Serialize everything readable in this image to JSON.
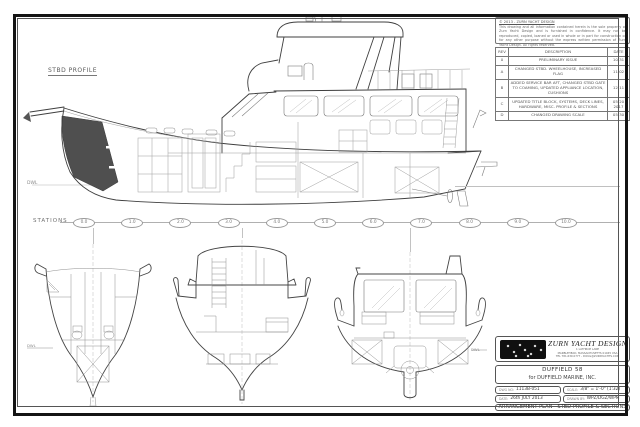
{
  "drawing": {
    "profile_label": "STBD PROFILE",
    "profile_dwl_label": "DWL",
    "stations_label": "STATIONS",
    "stations": [
      "0.0",
      "1.0",
      "2.0",
      "3.0",
      "4.0",
      "5.0",
      "6.0",
      "7.0",
      "8.0",
      "9.0",
      "10.0"
    ],
    "fwd_section_dwl_label": "DWL",
    "aft_section_dwl_label": "DWL"
  },
  "notes": {
    "title": "© 2013 - ZURN YACHT DESIGN",
    "body": "This drawing and all information contained herein is the sole property of Zurn Yacht Design and is furnished in confidence. It may not be reproduced, copied, loaned or used in whole or in part for construction or for any other purpose without the express written permission of Zurn Yacht Design. All rights reserved."
  },
  "revision_table": {
    "headers": [
      "REV",
      "DESCRIPTION",
      "DATE"
    ],
    "rows": [
      {
        "rev": "0",
        "description": "PRELIMINARY ISSUE",
        "date": "10-31"
      },
      {
        "rev": "A",
        "description": "CHANGED STBD. WHEELHOUSE, INCREASED FLAG",
        "date": "11-02"
      },
      {
        "rev": "B",
        "description": "ADDED SERVICE BAR AFT, CHANGED STBD GATE TO COAMING, UPDATED APPLIANCE LOCATION, CUSHIONS",
        "date": "12-11"
      },
      {
        "rev": "C",
        "description": "UPDATED TITLE BLOCK, SYSTEMS, DECK LINES, HARDWARE, MISC. PROFILE & SECTIONS",
        "date": "05-20 2017"
      },
      {
        "rev": "D",
        "description": "CHANGED DRAWING SCALE",
        "date": "05-30"
      }
    ]
  },
  "title_block": {
    "company": "ZURN YACHT DESIGN",
    "address_lines": [
      "1 LATHROP LANE",
      "MARBLEHEAD, MASSACHUSETTS 01945 USA",
      "TEL 781.639.0777  -  DOUG@ZURNYACHTS.COM"
    ],
    "project": "DUFFIELD 58",
    "client": "for DUFFIELD MARINE, INC.",
    "dwg_no_label": "DWG NO:",
    "dwg_no": "1113B-051",
    "scale_label": "SCALE:",
    "scale": "3/8\" = 1'-0\" (1:32)",
    "date_label": "DATE:",
    "date": "26th JULY 2013",
    "drawn_by_label": "DRAWN BY:",
    "drawn_by": "WPZ/DGZ/WPM",
    "drawing_title": "ARRANGEMENT PLAN - STBD PROFILE & SECTIONS"
  }
}
